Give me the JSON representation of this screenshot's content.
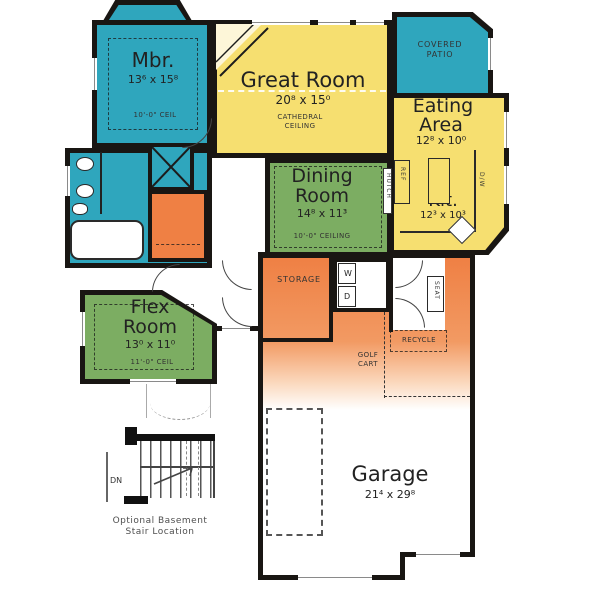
{
  "palette": {
    "teal": "#2fa6bd",
    "yellow": "#f6df70",
    "green": "#7cad62",
    "orange": "#ef8044",
    "wall": "#191613",
    "ink": "#222222",
    "caption": "#4f4f4f"
  },
  "rooms": {
    "master_bedroom": {
      "name": "Mbr.",
      "dims": "13⁶ x 15⁸",
      "ceiling": "10'-0\" CEIL"
    },
    "great_room": {
      "name": "Great Room",
      "dims": "20⁸ x 15⁰",
      "ceiling_line1": "CATHEDRAL",
      "ceiling_line2": "CEILING"
    },
    "covered_patio": {
      "line1": "COVERED",
      "line2": "PATIO"
    },
    "eating_area": {
      "line1": "Eating",
      "line2": "Area",
      "dims": "12⁸ x 10⁰"
    },
    "kitchen": {
      "name": "Kit.",
      "dims": "12³ x 10³"
    },
    "dining_room": {
      "line1": "Dining",
      "line2": "Room",
      "dims": "14⁸ x 11³",
      "ceiling": "10'-0\" CEILING"
    },
    "flex_room": {
      "line1": "Flex",
      "line2": "Room",
      "dims": "13⁰ x 11⁰",
      "ceiling": "11'-0\" CEIL"
    },
    "garage": {
      "name": "Garage",
      "dims": "21⁴ x 29⁸"
    }
  },
  "annotations": {
    "storage": "STORAGE",
    "golf_line1": "GOLF",
    "golf_line2": "CART",
    "recycle": "RECYCLE",
    "seat": "SEAT",
    "hutch": "HUTCH",
    "washer": "W",
    "dryer": "D",
    "dishwasher": "D/W",
    "refrigerator": "REF",
    "stairs_dn": "DN",
    "stair_caption_line1": "Optional Basement",
    "stair_caption_line2": "Stair Location"
  }
}
